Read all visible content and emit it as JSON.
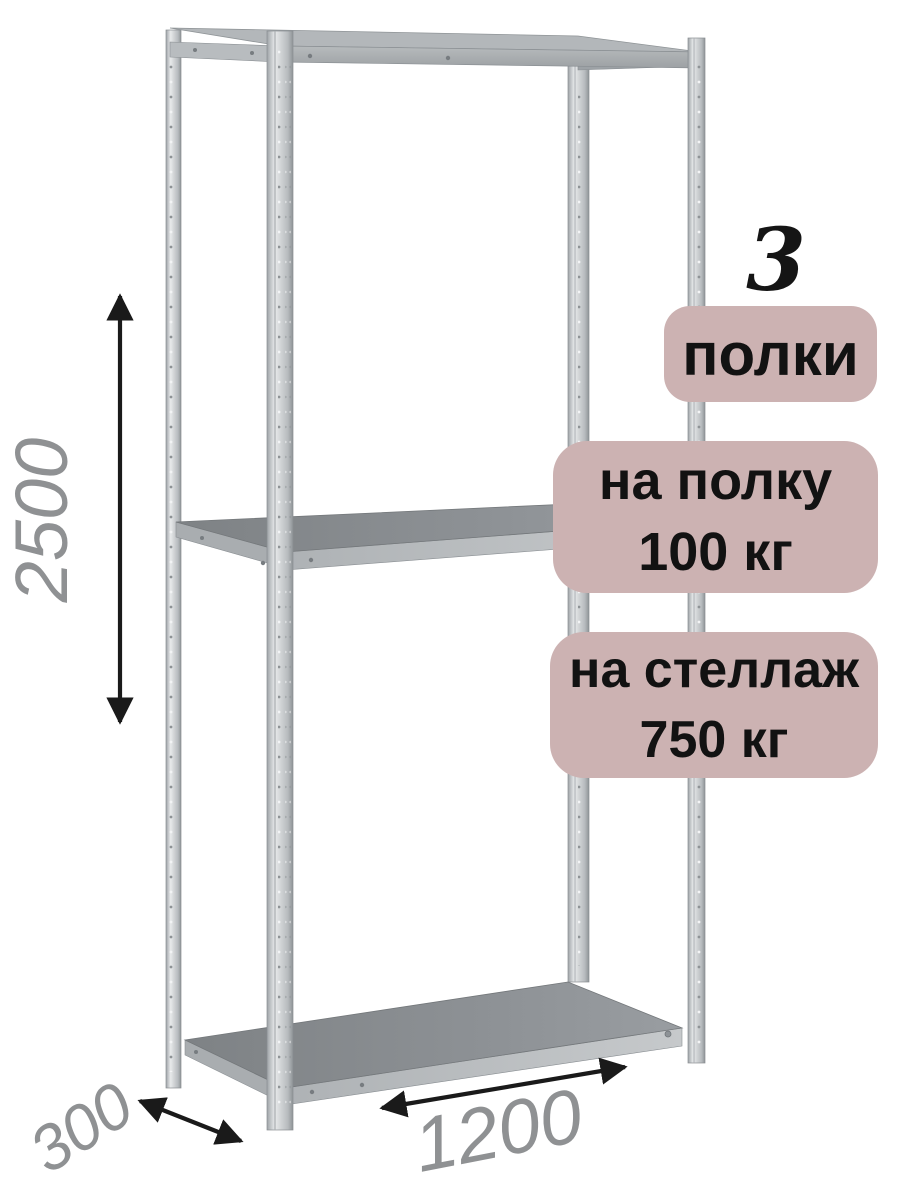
{
  "product": {
    "description": "Metal boltless shelving rack illustration with dimension callouts"
  },
  "dimensions": {
    "height": "2500",
    "depth": "300",
    "width": "1200"
  },
  "badges": {
    "count_value": "3",
    "count_caption": "полки",
    "shelf_load_title": "на полку",
    "shelf_load_value": "100 кг",
    "rack_load_title": "на стеллаж",
    "rack_load_value": "750 кг"
  },
  "colors": {
    "background": "#ffffff",
    "badge_background": "#ccb2b2",
    "badge_text": "#121212",
    "dimension_text": "#8f9193",
    "arrow": "#1a1a1a",
    "metal_highlight": "#e8eaeb",
    "metal_base": "#c9cccf",
    "shelf_surface": "#85898c"
  }
}
